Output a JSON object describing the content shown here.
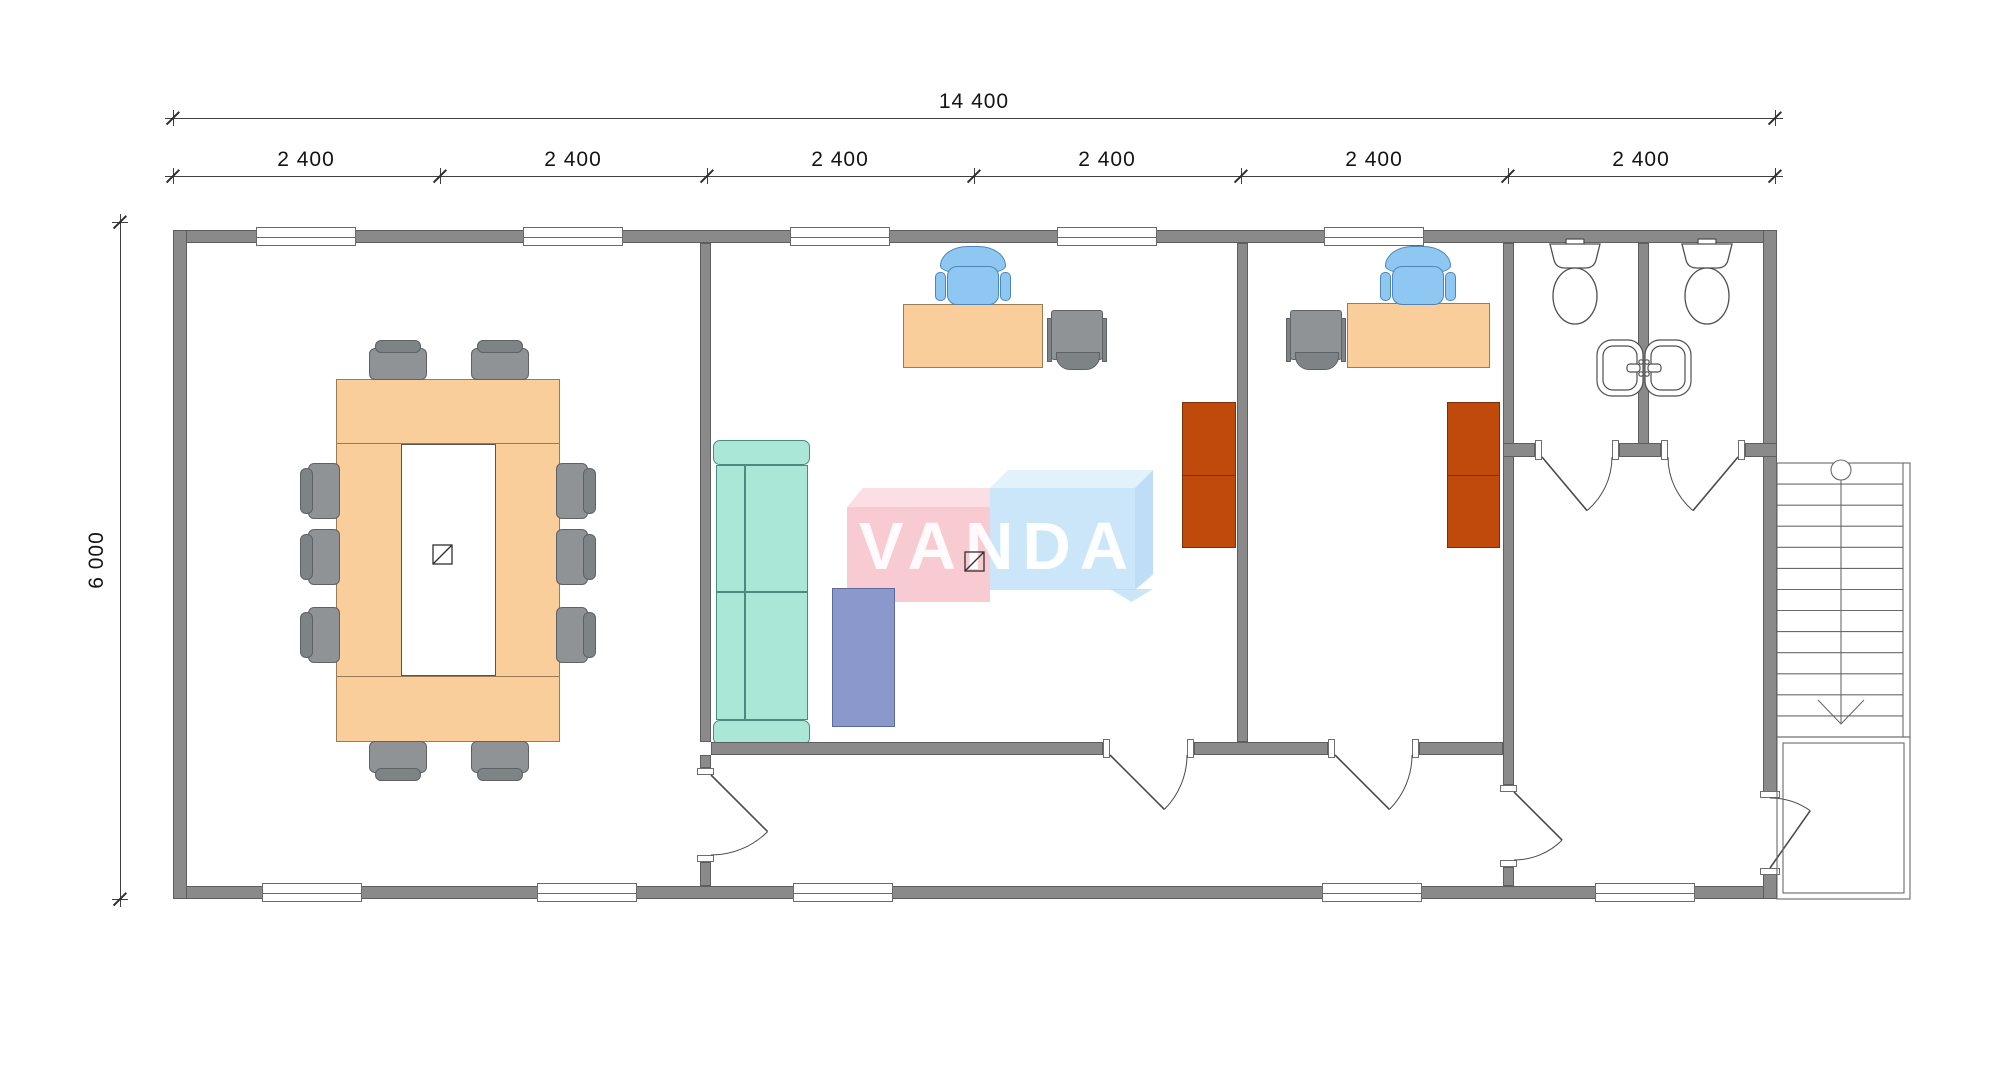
{
  "drawing": {
    "type": "architectural-floor-plan",
    "description": "Single-storey modular office floor plan with conference room, two offices, corridor, two WC stalls with sinks, entry hall and external staircase"
  },
  "dimension_annotations": {
    "overall_width": {
      "label": "14 400"
    },
    "overall_height": {
      "label": "6 000"
    },
    "modules": {
      "labels": [
        "2 400",
        "2 400",
        "2 400",
        "2 400",
        "2 400",
        "2 400"
      ]
    }
  },
  "watermark": {
    "text": "VANDA",
    "left_text": "VAN",
    "right_text": "DA",
    "pink_front": "rgba(243,158,172,0.55)",
    "pink_top": "rgba(248,196,205,0.55)",
    "blue_front": "rgba(168,213,245,0.60)",
    "blue_top": "rgba(206,233,250,0.60)",
    "blue_right": "rgba(148,199,240,0.60)"
  },
  "colors": {
    "wall": "#8a8a8a",
    "wall_edge": "#5e5e5e",
    "window_fill": "#ffffff",
    "window_edge": "#6a6a6a",
    "desk_orange": "#f9ce9b",
    "desk_edge": "#9b7b52",
    "chair_gray": "#8f9396",
    "chair_gray_back": "#7e8386",
    "chair_gray_edge": "#5f6264",
    "office_chair_blue": "#8fc7f3",
    "office_chair_edge": "#4e86b8",
    "sofa_teal": "#abe7d7",
    "sofa_edge": "#4d8a80",
    "table_blue": "#8b98cb",
    "table_blue_edge": "#5e6a9d",
    "wardrobe_orange": "#c04a0c",
    "wardrobe_edge": "#7a3008",
    "fixture_line": "#4f4f4f",
    "stair_line": "#6a6a6a",
    "door_line": "#4a4a4a",
    "dim_line": "#3f3f3f",
    "dim_text": "#141414"
  },
  "plan": {
    "canvas": {
      "width": 2000,
      "height": 1076
    },
    "dim1": {
      "y": 118,
      "x1": 173,
      "x2": 1775,
      "label_x": 974,
      "label_y": 90
    },
    "dim2": {
      "y": 176,
      "ticks": [
        173,
        440,
        707,
        974,
        1241,
        1508,
        1775
      ],
      "label_centers": [
        306,
        573,
        840,
        1107,
        1374,
        1641
      ],
      "label_y": 148
    },
    "dimv": {
      "x": 120,
      "y1": 222,
      "y2": 899,
      "label_x": 97,
      "label_y": 560
    },
    "walls": [
      [
        173,
        230,
        1604,
        13
      ],
      [
        173,
        886,
        1604,
        13
      ],
      [
        173,
        230,
        14,
        669
      ],
      [
        1763,
        230,
        14,
        568
      ],
      [
        1763,
        868,
        14,
        31
      ],
      [
        700,
        243,
        11,
        499
      ],
      [
        700,
        755,
        11,
        13
      ],
      [
        700,
        862,
        11,
        24
      ],
      [
        1237,
        243,
        11,
        499
      ],
      [
        1503,
        243,
        11,
        542
      ],
      [
        1503,
        867,
        11,
        19
      ],
      [
        1638,
        243,
        11,
        214
      ],
      [
        1503,
        443,
        32,
        14
      ],
      [
        1619,
        443,
        42,
        14
      ],
      [
        1745,
        443,
        32,
        14
      ],
      [
        711,
        742,
        392,
        13
      ],
      [
        1194,
        742,
        134,
        13
      ],
      [
        1419,
        742,
        84,
        13
      ]
    ],
    "jambs": [
      [
        697,
        768,
        17,
        7
      ],
      [
        697,
        855,
        17,
        7
      ],
      [
        1500,
        785,
        17,
        7
      ],
      [
        1500,
        860,
        17,
        7
      ],
      [
        1103,
        739,
        7,
        19
      ],
      [
        1187,
        739,
        7,
        19
      ],
      [
        1328,
        739,
        7,
        19
      ],
      [
        1412,
        739,
        7,
        19
      ],
      [
        1535,
        440,
        7,
        20
      ],
      [
        1612,
        440,
        7,
        20
      ],
      [
        1661,
        440,
        7,
        20
      ],
      [
        1738,
        440,
        7,
        20
      ],
      [
        1760,
        791,
        20,
        7
      ],
      [
        1760,
        868,
        20,
        7
      ]
    ],
    "windows_top": {
      "y": 227,
      "h": 19,
      "w": 100,
      "centers": [
        306,
        573,
        840,
        1107,
        1374
      ]
    },
    "windows_bottom": {
      "y": 883,
      "h": 19,
      "w": 100,
      "centers": [
        312,
        587,
        843,
        1372,
        1645
      ]
    },
    "doors": [
      {
        "name": "door-conference",
        "leaf": [
          711,
          775,
          767.6,
          831.6
        ],
        "arc": "M767.6,831.6 A80,80 0 0 1 711,855"
      },
      {
        "name": "door-office-1",
        "leaf": [
          1110,
          755,
          1164.4,
          809.4
        ],
        "arc": "M1164.4,809.4 A77,77 0 0 0 1187,755"
      },
      {
        "name": "door-office-2",
        "leaf": [
          1335,
          755,
          1389.4,
          809.4
        ],
        "arc": "M1389.4,809.4 A77,77 0 0 0 1412,755"
      },
      {
        "name": "door-hall",
        "leaf": [
          1514,
          792,
          1562.1,
          840.1
        ],
        "arc": "M1562.1,840.1 A68,68 0 0 1 1514,860"
      },
      {
        "name": "door-wc-left",
        "leaf": [
          1542,
          457,
          1587,
          510.6
        ],
        "arc": "M1587,510.6 A70,70 0 0 0 1612,457"
      },
      {
        "name": "door-wc-right",
        "leaf": [
          1738,
          457,
          1693,
          510.6
        ],
        "arc": "M1693,510.6 A70,70 0 0 1 1668,457"
      },
      {
        "name": "door-entrance",
        "leaf": [
          1770,
          868,
          1810.2,
          810.7
        ],
        "arc": "M1810.2,810.7 A70,70 0 0 0 1770,798"
      }
    ],
    "conference_table": {
      "x": 336,
      "y": 379,
      "w": 224,
      "h": 363,
      "inner": [
        401,
        444,
        95,
        232
      ],
      "lines_y": [
        443,
        676
      ]
    },
    "conference_chairs": {
      "north": [
        [
          369,
          340
        ],
        [
          471,
          340
        ]
      ],
      "south": [
        [
          369,
          741
        ],
        [
          471,
          741
        ]
      ],
      "west": [
        [
          300,
          463
        ],
        [
          300,
          529
        ],
        [
          300,
          607
        ]
      ],
      "east": [
        [
          556,
          463
        ],
        [
          556,
          529
        ],
        [
          556,
          607
        ]
      ]
    },
    "desks": [
      [
        903,
        304,
        140,
        64
      ],
      [
        1347,
        303,
        143,
        65
      ]
    ],
    "office_chairs_cx": [
      973,
      1418
    ],
    "office_chairs_cy": 246,
    "guest_chairs": [
      [
        1047,
        310
      ],
      [
        1286,
        310
      ]
    ],
    "sofa": {
      "x": 713,
      "y": 440,
      "w": 97,
      "h": 305
    },
    "coffee_table": [
      832,
      588,
      63,
      139
    ],
    "wardrobes": [
      [
        1182,
        402,
        54,
        146
      ],
      [
        1447,
        402,
        53,
        146
      ]
    ],
    "symbols": [
      [
        433,
        545
      ],
      [
        965,
        552
      ]
    ],
    "toilets_cx": [
      1575,
      1707
    ],
    "sinks": [
      [
        1597,
        340,
        46,
        56
      ],
      [
        1645,
        340,
        46,
        56
      ]
    ],
    "stairs": {
      "x": 1777,
      "y": 463,
      "w": 133,
      "h": 274,
      "treads": 12,
      "inner_line_x": 1903,
      "center_x": 1841,
      "landing": [
        1777,
        737,
        133,
        162
      ],
      "landing_inner": [
        1783,
        743,
        121,
        150
      ]
    }
  }
}
